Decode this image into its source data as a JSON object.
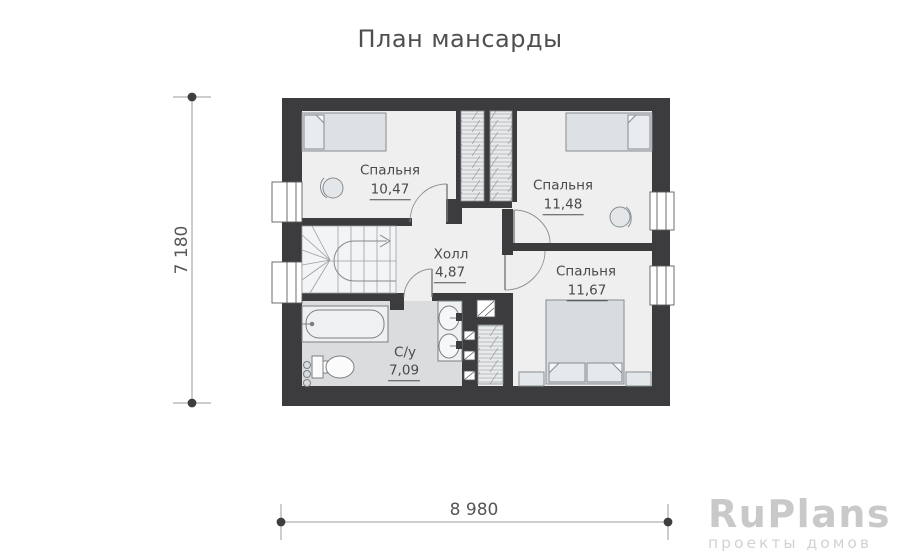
{
  "title": "План мансарды",
  "floor_plan": {
    "rooms": [
      {
        "id": "bedroom-1",
        "name": "Спальня",
        "area": "10,47"
      },
      {
        "id": "bedroom-2",
        "name": "Спальня",
        "area": "11,48"
      },
      {
        "id": "bedroom-3",
        "name": "Спальня",
        "area": "11,67"
      },
      {
        "id": "hall",
        "name": "Холл",
        "area": "4,87"
      },
      {
        "id": "bathroom",
        "name": "С/у",
        "area": "7,09"
      }
    ],
    "fixtures": [
      "bed",
      "bed",
      "double-bed",
      "wardrobe",
      "wardrobe",
      "wardrobe",
      "stairs",
      "bathtub",
      "toilet",
      "sink",
      "sink",
      "vent-shaft"
    ],
    "colors": {
      "wall": "#3c3c3e",
      "floor": "#efefef",
      "bathroom_floor": "#dadcde",
      "furniture_fill": "#dfe2e5",
      "stroke": "#85898d",
      "label_text": "#4a4a4a"
    }
  },
  "dimensions": {
    "height": "7 180",
    "width": "8 980"
  },
  "watermark": {
    "brand": "RuPlans",
    "tagline": "проекты домов"
  }
}
